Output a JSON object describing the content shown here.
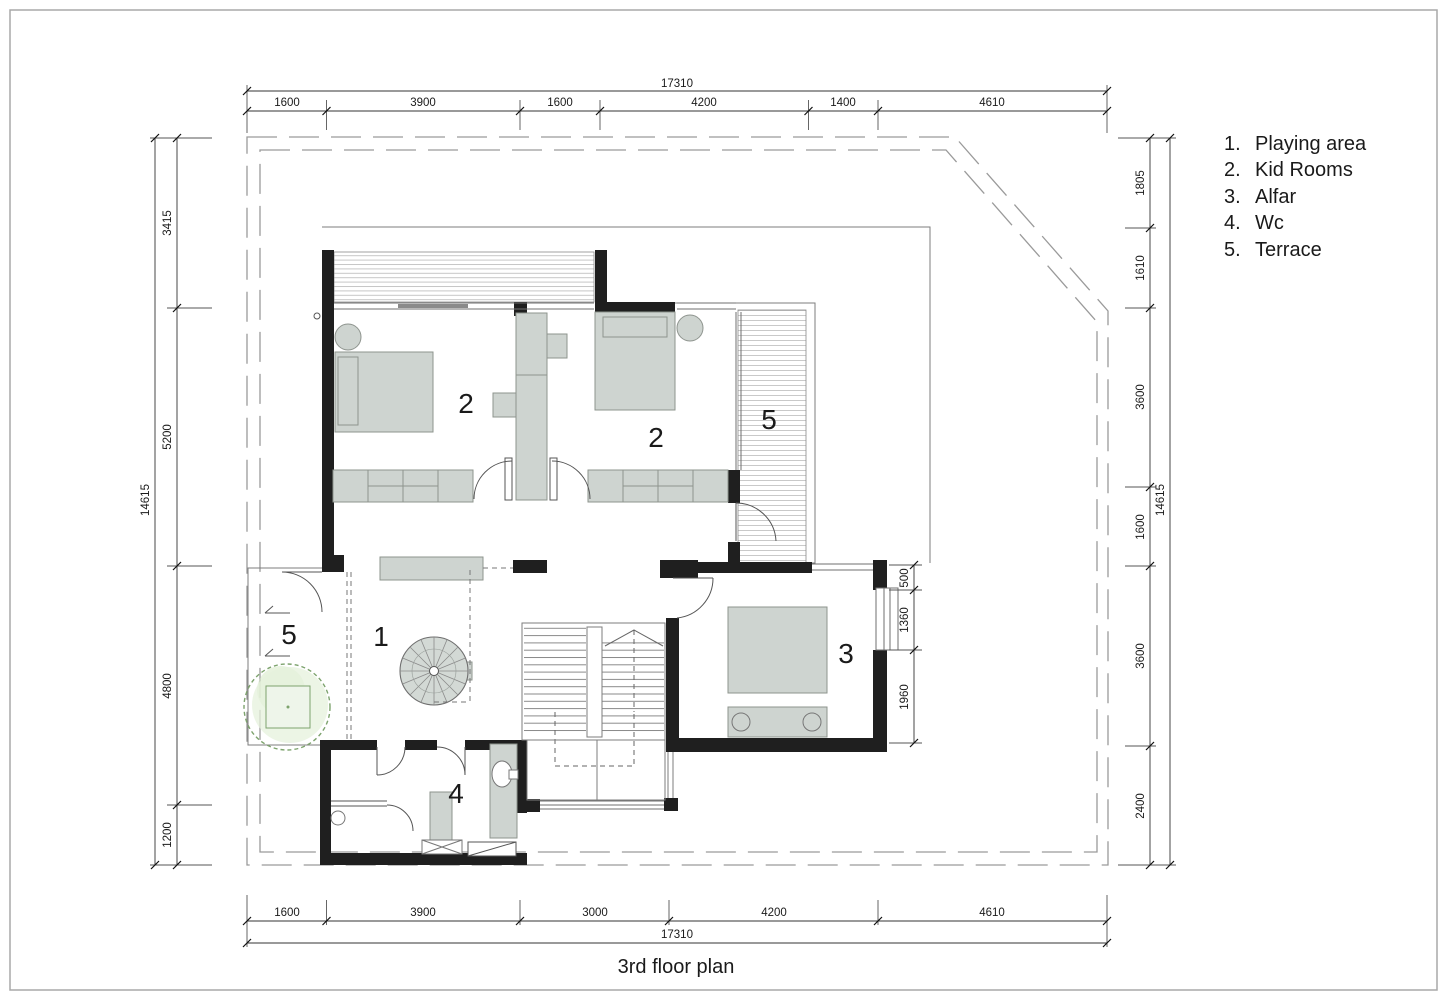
{
  "title": "3rd floor plan",
  "legend": [
    {
      "num": "1.",
      "label": "Playing area"
    },
    {
      "num": "2.",
      "label": "Kid Rooms"
    },
    {
      "num": "3.",
      "label": "Alfar"
    },
    {
      "num": "4.",
      "label": "Wc"
    },
    {
      "num": "5.",
      "label": "Terrace"
    }
  ],
  "room_markers": {
    "kid_room_left": "2",
    "kid_room_right": "2",
    "terrace_upper": "5",
    "playing_area": "1",
    "alfar": "3",
    "wc": "4",
    "terrace_lower": "5"
  },
  "dimensions": {
    "top": {
      "overall": "17310",
      "segments": [
        "1600",
        "3900",
        "1600",
        "4200",
        "1400",
        "4610"
      ]
    },
    "bottom": {
      "overall": "17310",
      "segments": [
        "1600",
        "3900",
        "3000",
        "4200",
        "4610"
      ]
    },
    "left": {
      "overall": "14615",
      "segments": [
        "3415",
        "5200",
        "4800",
        "1200"
      ]
    },
    "right": {
      "overall": "14615",
      "segments": [
        "1805",
        "1610",
        "3600",
        "1600",
        "3600",
        "2400"
      ]
    },
    "alfar_side": {
      "segments": [
        "500",
        "1360",
        "1960"
      ]
    }
  },
  "colors": {
    "wall": "#1f1f1f",
    "furniture_fill": "#ced4d0",
    "tree_green": "#7da36d",
    "boundary_gray": "#9a9a9a"
  }
}
